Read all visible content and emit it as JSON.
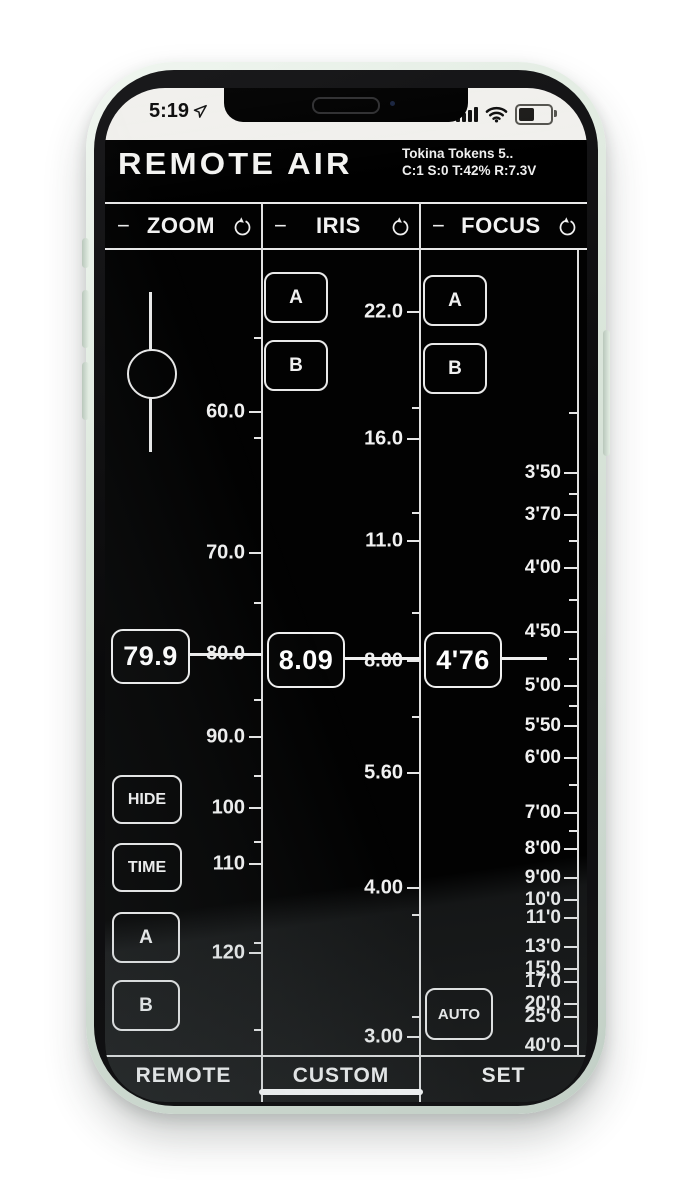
{
  "status_bar": {
    "time": "5:19"
  },
  "header": {
    "app_title": "REMOTE AIR",
    "device_info_line1": "Tokina Tokens 5..",
    "device_info_line2": "C:1 S:0 T:42% R:7.3V"
  },
  "icons": {
    "minimize": "−",
    "reset": "counterclockwise-circular-arrow",
    "location": "navigation-arrow",
    "signal": "cellular-bars-4",
    "wifi": "wifi",
    "battery": "battery-half"
  },
  "columns": {
    "zoom": {
      "title": "ZOOM",
      "minus": "−",
      "current_value": "79.9",
      "scale_labels": [
        "60.0",
        "70.0",
        "80.0",
        "90.0",
        "100",
        "110",
        "120"
      ],
      "buttons": {
        "hide": "HIDE",
        "time": "TIME",
        "a": "A",
        "b": "B"
      }
    },
    "iris": {
      "title": "IRIS",
      "minus": "−",
      "current_value": "8.09",
      "scale_labels": [
        "22.0",
        "16.0",
        "11.0",
        "8.00",
        "5.60",
        "4.00",
        "3.00"
      ],
      "buttons": {
        "a": "A",
        "b": "B"
      }
    },
    "focus": {
      "title": "FOCUS",
      "minus": "−",
      "current_value": "4'76",
      "scale_labels": [
        "3'50",
        "3'70",
        "4'00",
        "4'50",
        "5'00",
        "5'50",
        "6'00",
        "7'00",
        "8'00",
        "9'00",
        "10'0",
        "11'0",
        "13'0",
        "15'0",
        "17'0",
        "20'0",
        "25'0",
        "40'0"
      ],
      "buttons": {
        "auto": "AUTO",
        "a": "A",
        "b": "B"
      }
    }
  },
  "tabs": {
    "remote": "REMOTE",
    "custom": "CUSTOM",
    "set": "SET",
    "active_tab": "CUSTOM"
  }
}
